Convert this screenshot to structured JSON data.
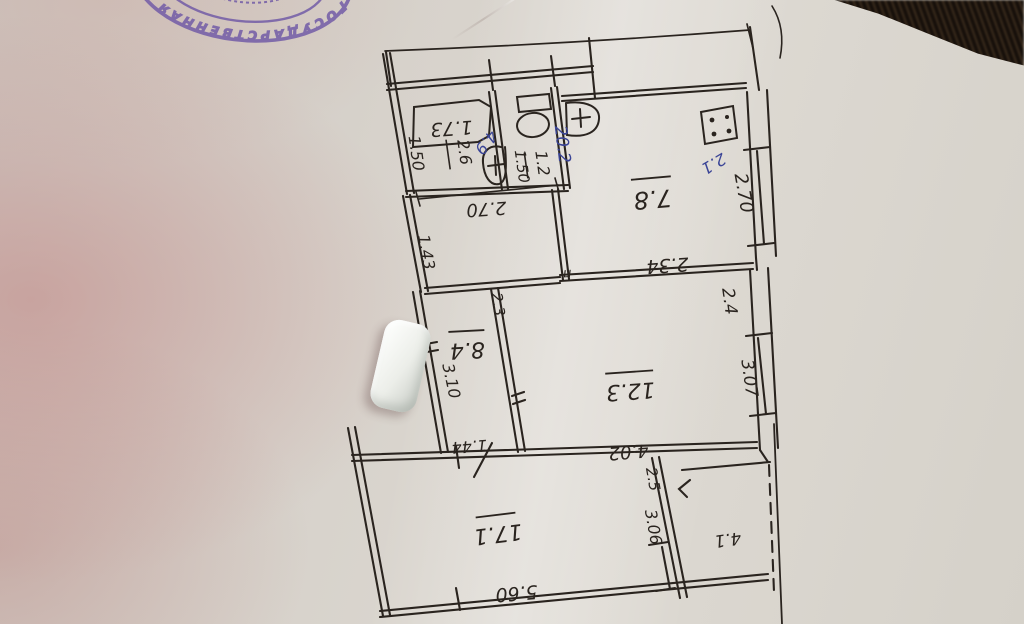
{
  "stamp": {
    "arc_text": "ГОСУДАРСТВЕННАЯ Р",
    "color": "#6f58a6"
  },
  "plan": {
    "ink_color": "#2a241f",
    "blue_ink_color": "#3a4496",
    "areas": {
      "kitchen": "7.8",
      "living_room": "12.3",
      "bedroom": "8.4",
      "big_room": "17.1",
      "balcony": "4.1",
      "bathroom": "2.6",
      "toilet": "1.2"
    },
    "dimensions": {
      "bathtub": "1.73",
      "bathroom_width": "1.50",
      "toilet_width": "1.50",
      "hallway": "2.70",
      "left_upper": "1.43",
      "kitchen_right": "2.70",
      "kitchen_bottom": "2.34",
      "living_right_upper": "2.4",
      "living_right": "3.07",
      "living_bottom": "4.02",
      "bedroom_top": "2.3",
      "bedroom_left": "3.10",
      "bedroom_bottom": "1.44",
      "big_room_bottom": "5.60",
      "big_room_right_upper": "2.5",
      "big_room_right": "3.06"
    },
    "blue_notes": {
      "total": "20.2",
      "kitchen": "2.1",
      "hall": "4.9"
    },
    "door_symbol": "п"
  }
}
